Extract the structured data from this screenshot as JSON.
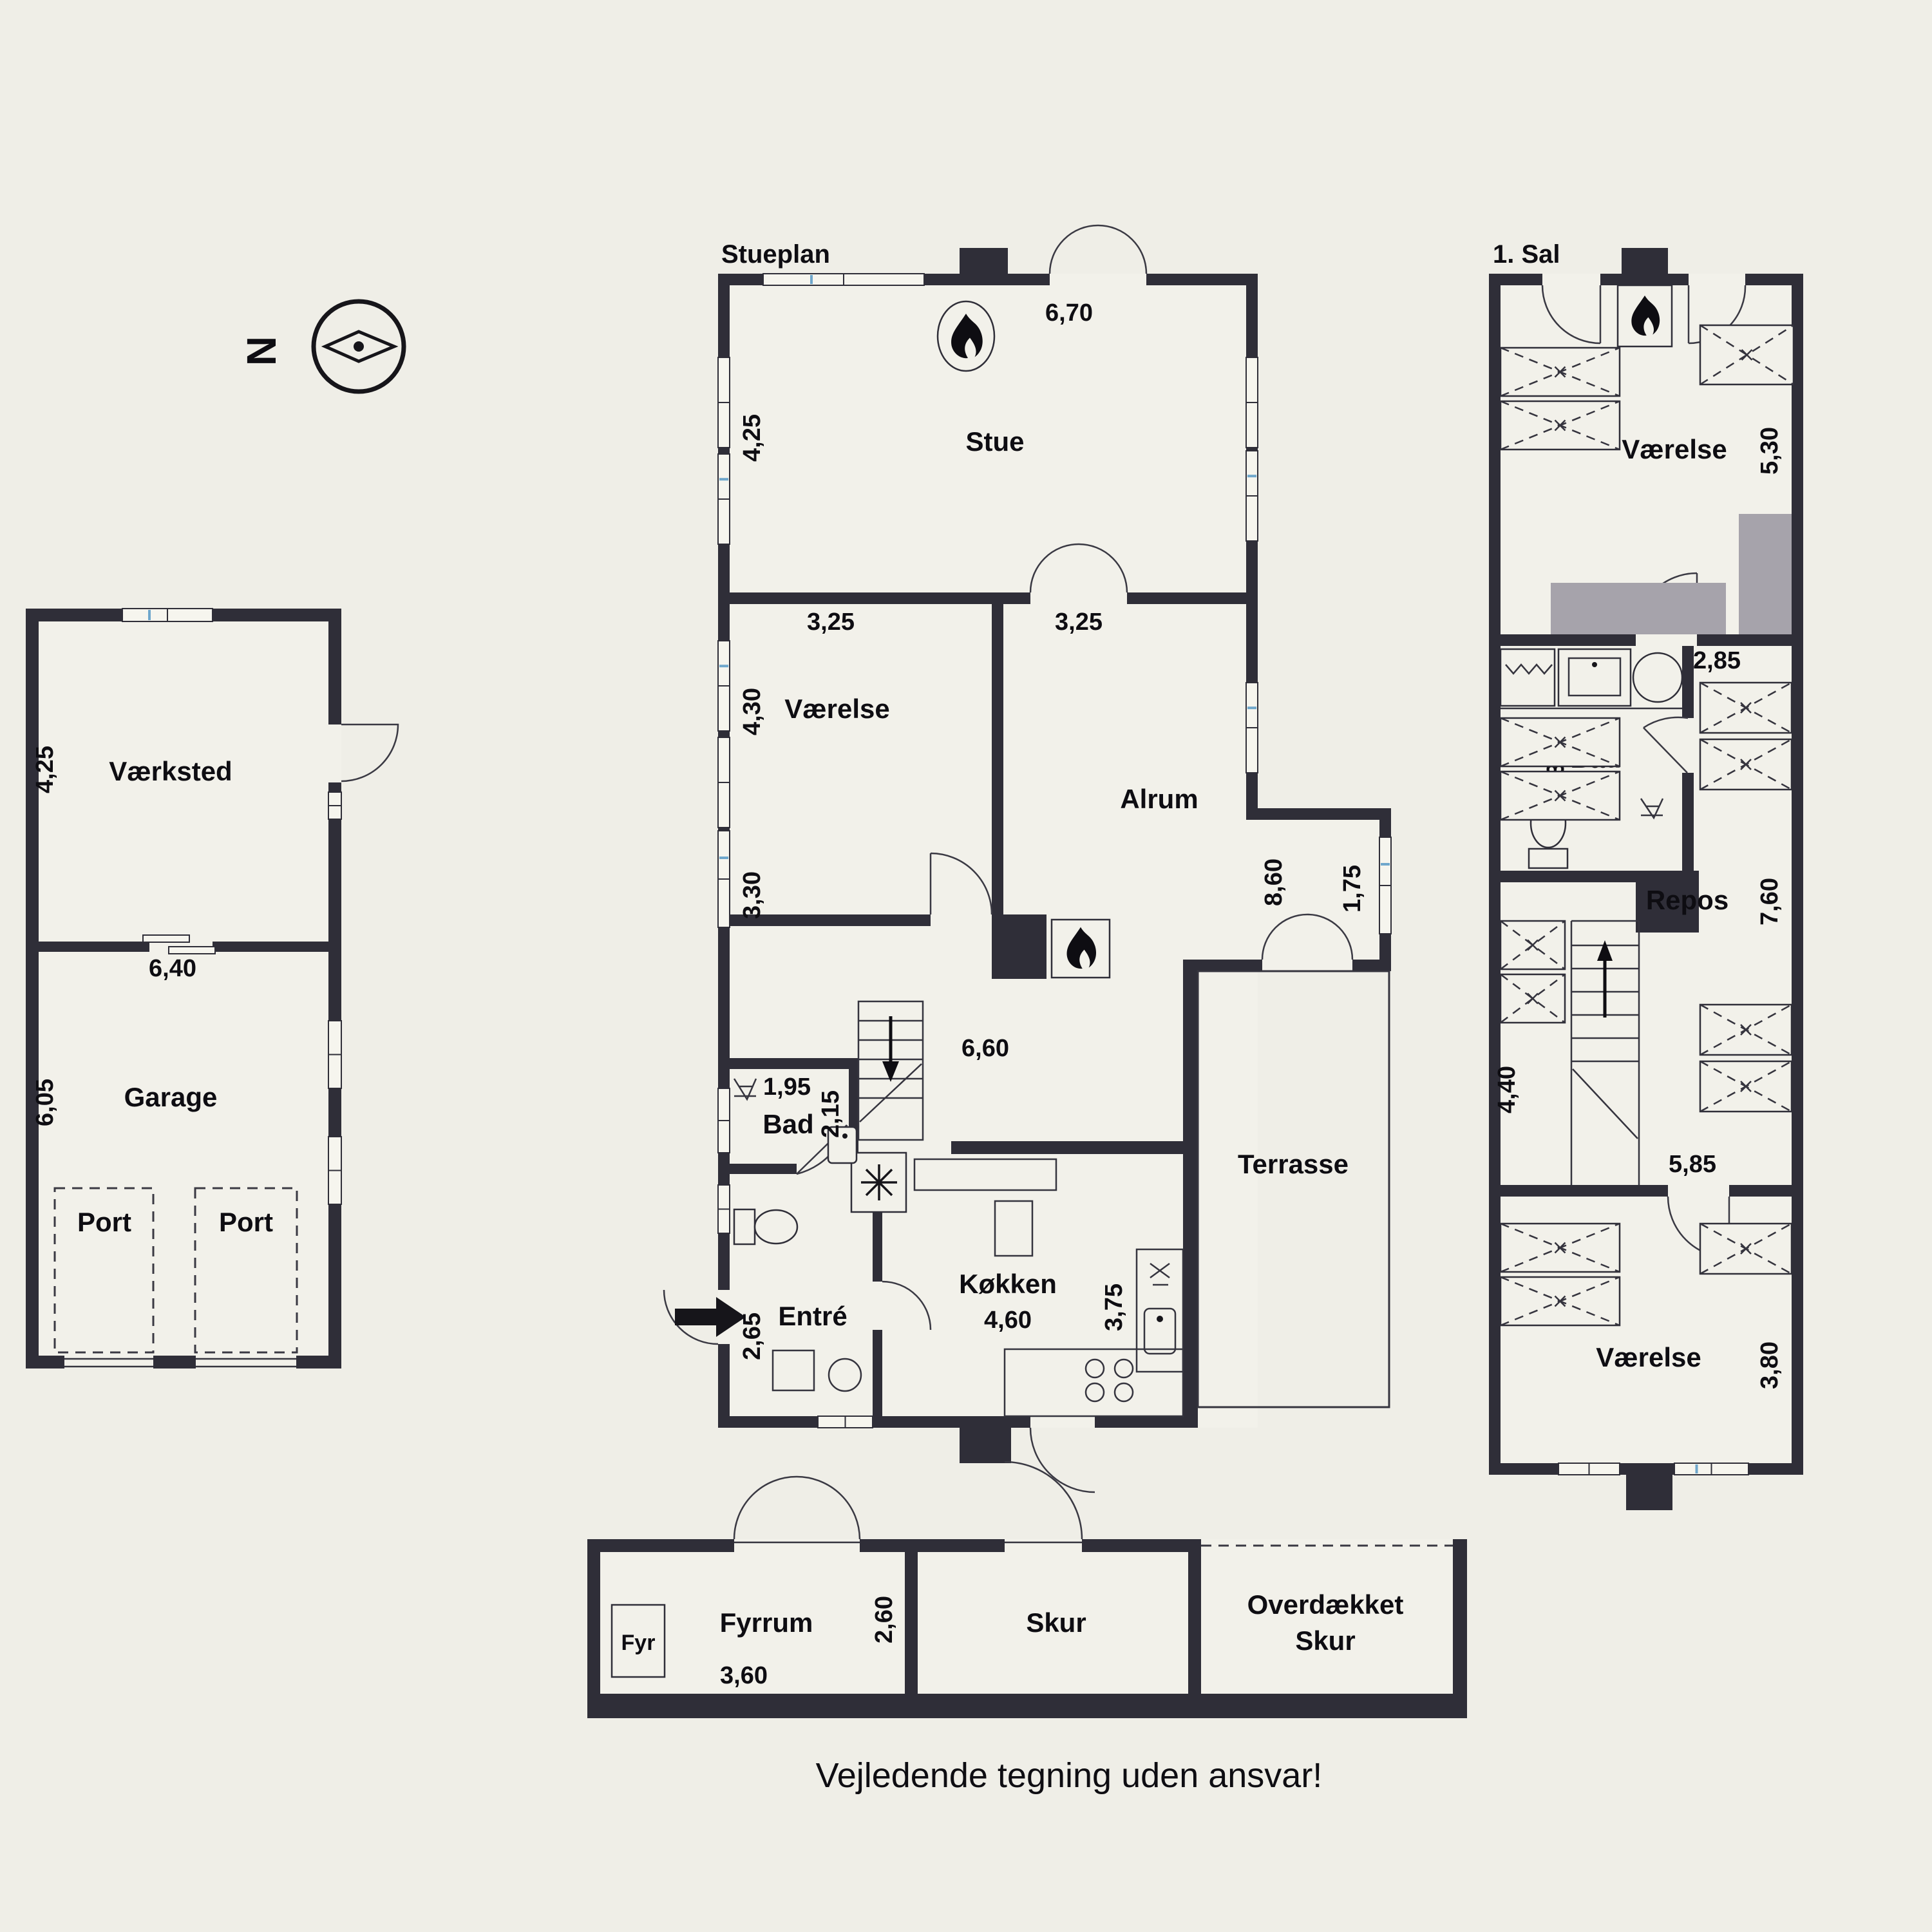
{
  "colors": {
    "background": "#efeee7",
    "wall": "#2f2e38",
    "furniture_gray": "#a6a3ab",
    "window_accent": "#6fa7cc"
  },
  "compass": {
    "north": "N"
  },
  "disclaimer": "Vejledende tegning uden ansvar!",
  "garage_building": {
    "vaerksted": {
      "label": "Værksted",
      "height": "4,25"
    },
    "divider_width": "6,40",
    "garage": {
      "label": "Garage",
      "height": "6,05",
      "port_left": "Port",
      "port_right": "Port"
    }
  },
  "stueplan": {
    "title": "Stueplan",
    "stue": {
      "label": "Stue",
      "width": "6,70",
      "height": "4,25",
      "door": "3,25"
    },
    "vaerelse": {
      "label": "Værelse",
      "width": "3,25",
      "height": "4,30"
    },
    "lower_left_height": "3,30",
    "alrum": {
      "label": "Alrum",
      "height": "8,60",
      "window": "1,75",
      "span": "6,60"
    },
    "bad": {
      "label": "Bad",
      "width": "1,95",
      "depth": "2,15"
    },
    "entre": {
      "label": "Entré",
      "height": "2,65"
    },
    "koekken": {
      "label": "Køkken",
      "width": "4,60",
      "height": "3,75"
    },
    "terrasse": {
      "label": "Terrasse"
    }
  },
  "first_floor": {
    "title": "1. Sal",
    "vaerelse_top": {
      "label": "Værelse",
      "height": "5,30",
      "door": "2,85"
    },
    "bad": {
      "label": "Bad",
      "width": "3,10"
    },
    "repos": {
      "label": "Repos",
      "height": "7,60"
    },
    "stairs": {
      "height": "4,40",
      "width": "5,85"
    },
    "vaerelse_bottom": {
      "label": "Værelse",
      "height": "3,80"
    }
  },
  "outbuilding": {
    "fyrrum": {
      "label": "Fyrrum",
      "boiler": "Fyr",
      "width": "3,60",
      "height": "2,60"
    },
    "skur": {
      "label": "Skur"
    },
    "overdaekket_skur": {
      "label_line1": "Overdækket",
      "label_line2": "Skur"
    }
  }
}
